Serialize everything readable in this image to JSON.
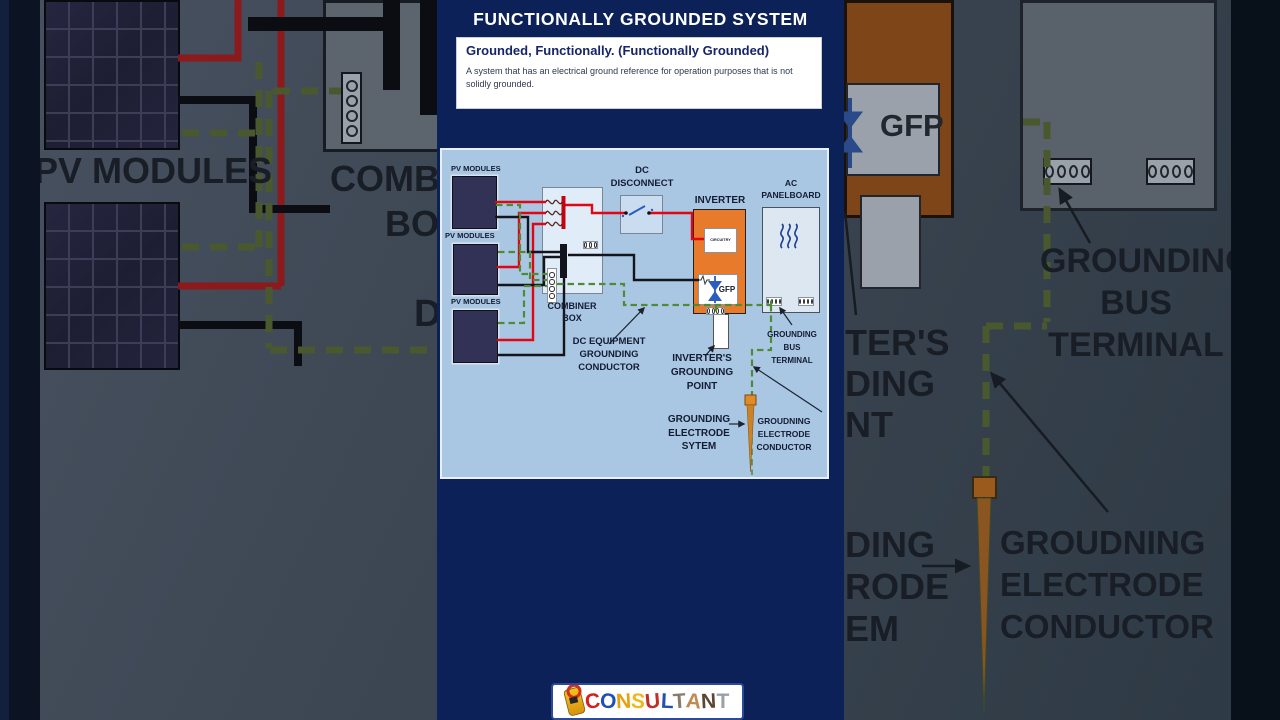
{
  "header": {
    "title": "FUNCTIONALLY GROUNDED SYSTEM",
    "definition": {
      "term": "Grounded, Functionally. (Functionally Grounded)",
      "body": "A system that has an electrical ground reference for operation purposes that is not solidly grounded."
    }
  },
  "diagram": {
    "labels": {
      "pv1": "PV MODULES",
      "pv2": "PV MODULES",
      "pv3": "PV MODULES",
      "dc_disconnect": [
        "DC",
        "DISCONNECT"
      ],
      "inverter": "INVERTER",
      "ac": [
        "AC",
        "PANELBOARD"
      ],
      "combiner": [
        "COMBINER",
        "BOX"
      ],
      "circuitry": "CIRCUITRY",
      "gfp": "GFP",
      "dc_equipment": [
        "DC EQUIPMENT",
        "GROUNDING",
        "CONDUCTOR"
      ],
      "inverters_grounding": [
        "INVERTER'S",
        "GROUNDING",
        "POINT"
      ],
      "grounding_bus": [
        "GROUNDING",
        "BUS",
        "TERMINAL"
      ],
      "grounding_electrode": [
        "GROUNDING",
        "ELECTRODE",
        "SYTEM"
      ],
      "electrode_conductor": [
        "GROUDNING",
        "ELECTRODE",
        "CONDUCTOR"
      ]
    }
  },
  "background": {
    "left": {
      "pv_modules": "PV MODULES",
      "combiner_fragment": "COMBI",
      "box": "BOX",
      "dc_fragment": "D"
    },
    "right": {
      "gfp": "GFP",
      "bus": [
        "GROUNDING",
        "BUS",
        "TERMINAL"
      ],
      "inverter_fragment": [
        "TER'S",
        "DING",
        "NT"
      ],
      "electrode_fragment": [
        "DING",
        "RODE",
        "EM"
      ],
      "conductor": [
        "GROUDNING",
        "ELECTRODE",
        "CONDUCTOR"
      ]
    }
  },
  "logo": {
    "letters": [
      {
        "ch": "C",
        "color": "#d42020",
        "rot": -6
      },
      {
        "ch": "O",
        "color": "#1d50b8",
        "rot": 4
      },
      {
        "ch": "N",
        "color": "#e8a010",
        "rot": -3
      },
      {
        "ch": "S",
        "color": "#f0b81c",
        "rot": 5
      },
      {
        "ch": "U",
        "color": "#c03028",
        "rot": -5
      },
      {
        "ch": "L",
        "color": "#2050b0",
        "rot": 3
      },
      {
        "ch": "T",
        "color": "#8a7a6a",
        "rot": -4
      },
      {
        "ch": "A",
        "color": "#c08a50",
        "rot": 6
      },
      {
        "ch": "N",
        "color": "#5a4632",
        "rot": -3
      },
      {
        "ch": "T",
        "color": "#9aa0a8",
        "rot": 0
      }
    ]
  },
  "colors": {
    "panel_navy": "#0c2158",
    "diagram_bg": "#a9c7e3",
    "wire_red": "#e00613",
    "wire_black": "#14141c",
    "ground_green": "#4f8a36",
    "inverter_orange": "#e87b2b",
    "electrode_orange": "#cc8326"
  }
}
